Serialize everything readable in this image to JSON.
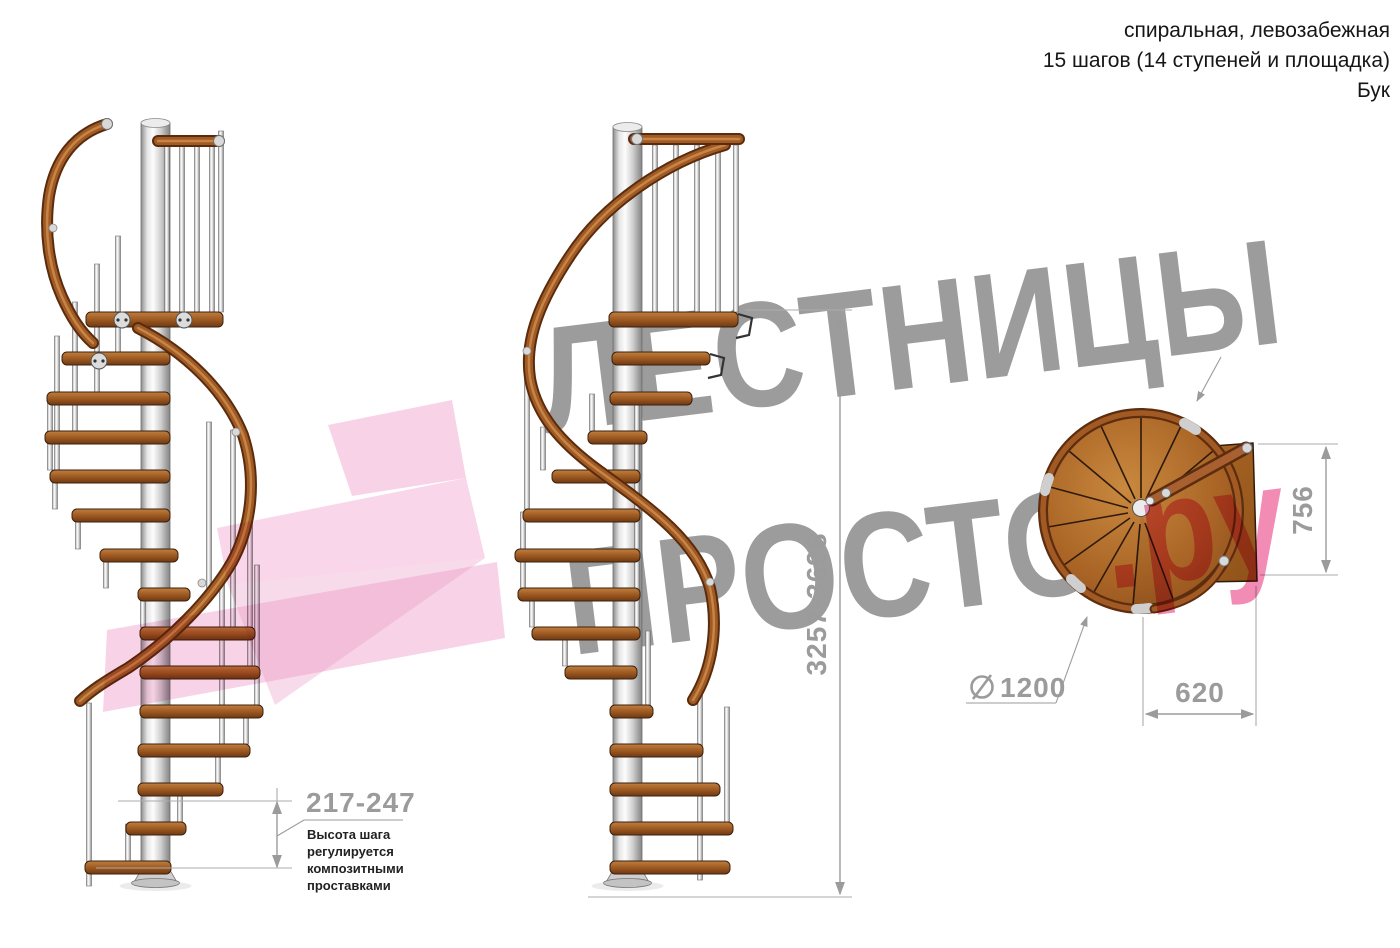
{
  "header": {
    "line1": "спиральная, левозабежная",
    "line2": "15 шагов (14 ступеней и площадка)",
    "line3": "Бук"
  },
  "watermark": {
    "line1": "ЛЕСТНИЦЫ",
    "line2": "ПРОСТО",
    "suffix": ".ру"
  },
  "dimensions": {
    "height_range": "3257-3698",
    "platform_depth": "756",
    "platform_width": "620",
    "diameter_symbol": "⌀",
    "diameter_value": "1200",
    "step_height_range": "217-247",
    "step_height_note": "Высота шага\nрегулируется\nкомпозитными\nпроставками"
  },
  "colors": {
    "wood": "#a05a24",
    "wood_dark": "#5a2b0d",
    "metal": "#d9d9d9",
    "dimension_gray": "#9b9b9b",
    "text": "#161616",
    "watermark_gray": "#9c9c9c",
    "watermark_pink": "#f178a8",
    "arrow_pink": "#f3aed3"
  }
}
